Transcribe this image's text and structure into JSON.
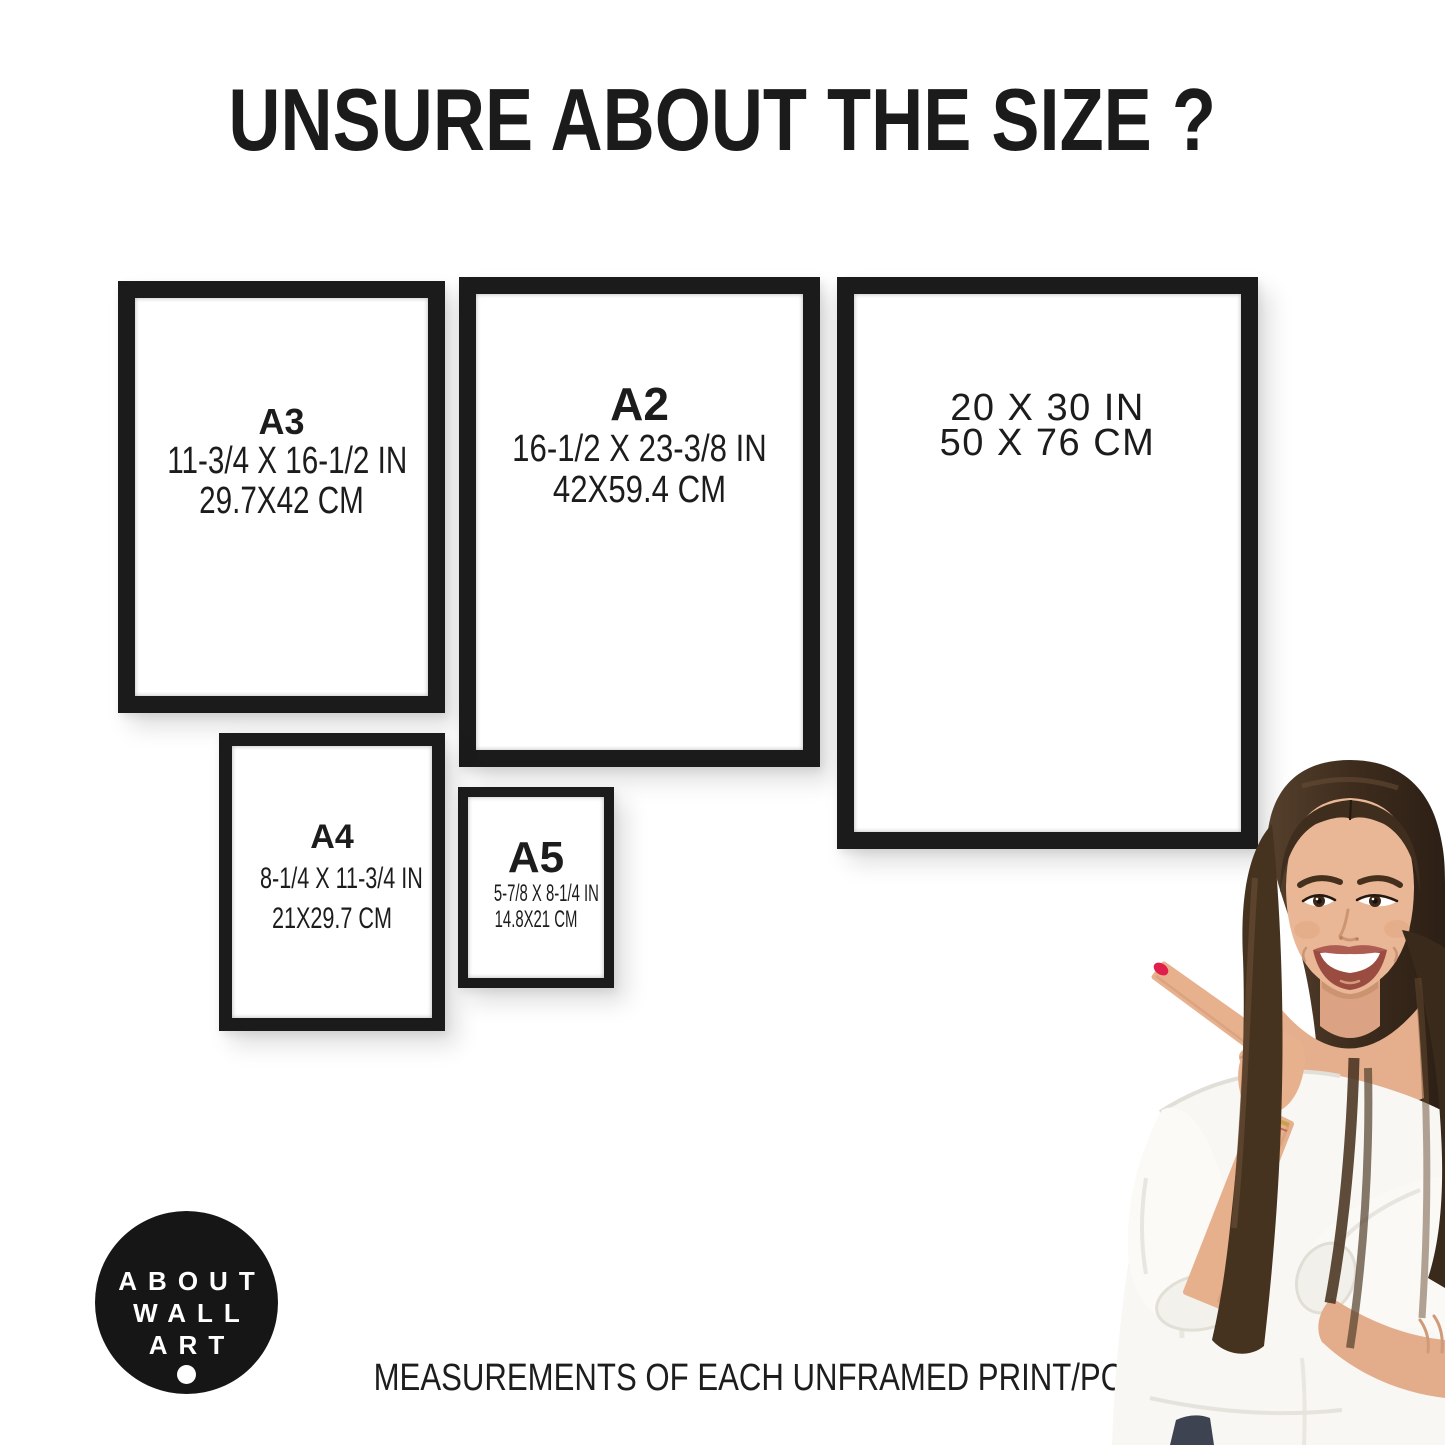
{
  "title": "UNSURE ABOUT THE SIZE ?",
  "frames": [
    {
      "name": "A3",
      "inches": "11-3/4 X 16-1/2 IN",
      "cm": "29.7X42 CM"
    },
    {
      "name": "A2",
      "inches": "16-1/2 X 23-3/8 IN",
      "cm": "42X59.4 CM"
    },
    {
      "name": "",
      "inches": "20 X 30 IN",
      "cm": "50 X 76 CM"
    },
    {
      "name": "A4",
      "inches": "8-1/4 X 11-3/4 IN",
      "cm": "21X29.7 CM"
    },
    {
      "name": "A5",
      "inches": "5-7/8 X 8-1/4 IN",
      "cm": "14.8X21 CM"
    }
  ],
  "logo": {
    "lines": [
      "ABOUT",
      "WALL",
      "ART"
    ]
  },
  "caption": "MEASUREMENTS OF EACH UNFRAMED PRINT/POSTER",
  "colors": {
    "background": "#ffffff",
    "frame_black": "#1b1b1b",
    "text": "#1c1c1c",
    "logo_background": "#161616",
    "logo_text": "#ffffff",
    "nail_polish": "#e0204a",
    "hair_brown": "#3f2d1e",
    "blouse_white": "#f8f7f4"
  }
}
